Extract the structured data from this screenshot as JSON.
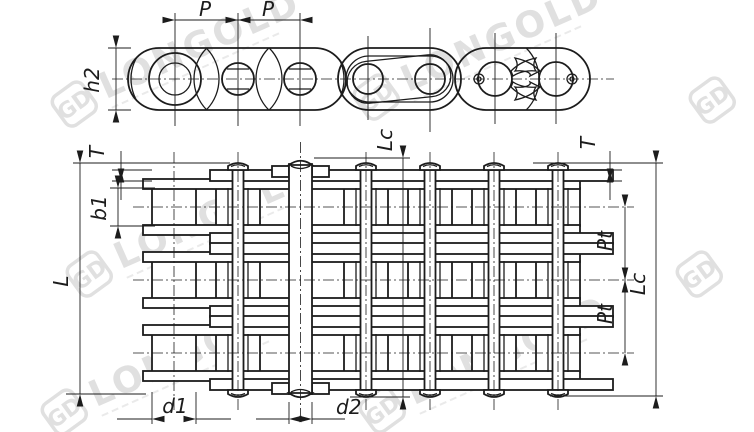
{
  "drawing": {
    "title": "roller-chain-technical-drawing",
    "background": "#ffffff",
    "line_color": "#1c1c1c",
    "watermark_color": "#c6c6c6",
    "watermark": {
      "brand": "LONGOLD",
      "logo": "GD"
    },
    "labels": {
      "p1": "P",
      "p2": "P",
      "h2": "h2",
      "lc_top": "Lc",
      "t_left": "T",
      "t_right": "T",
      "b1": "b1",
      "l": "L",
      "pt1": "Pt",
      "pt2": "Pt",
      "lc_right": "Lc",
      "d1": "d1",
      "d2": "d2"
    }
  }
}
